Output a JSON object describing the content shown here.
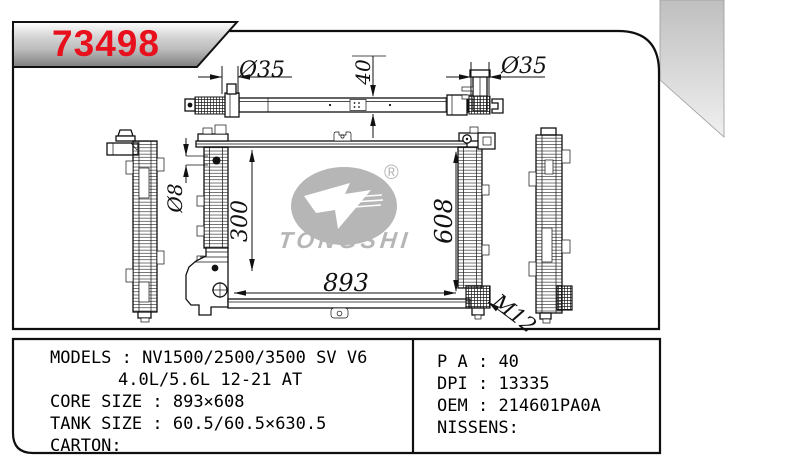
{
  "part_number": "73498",
  "watermark": {
    "brand": "TONGSHI",
    "registered_mark": "®"
  },
  "dimensions": {
    "left_inlet_diameter": "Ø35",
    "right_inlet_diameter": "Ø35",
    "tank_depth": "40",
    "pin_diameter": "Ø8",
    "bracket_height": "300",
    "core_width": "893",
    "core_height": "608",
    "drain_thread": "M12"
  },
  "specs_left": {
    "rows": [
      {
        "label": "MODELS",
        "sep": " : ",
        "value": "NV1500/2500/3500 SV V6"
      },
      {
        "label": "",
        "sep": "",
        "value": "4.0L/5.6L 12-21 AT"
      },
      {
        "label": "CORE SIZE",
        "sep": " : ",
        "value": "893×608"
      },
      {
        "label": "TANK SIZE",
        "sep": " : ",
        "value": "60.5/60.5×630.5"
      },
      {
        "label": "CARTON",
        "sep": ":",
        "value": ""
      }
    ]
  },
  "specs_right": {
    "rows": [
      {
        "label": "P A",
        "sep": " : ",
        "value": "40"
      },
      {
        "label": "DPI",
        "sep": " : ",
        "value": "13335"
      },
      {
        "label": "OEM",
        "sep": " : ",
        "value": "214601PA0A"
      },
      {
        "label": "NISSENS",
        "sep": ":",
        "value": ""
      }
    ]
  },
  "colors": {
    "accent_red": "#e8101c",
    "watermark_gray": "#b6b6b6",
    "line": "#111111"
  }
}
